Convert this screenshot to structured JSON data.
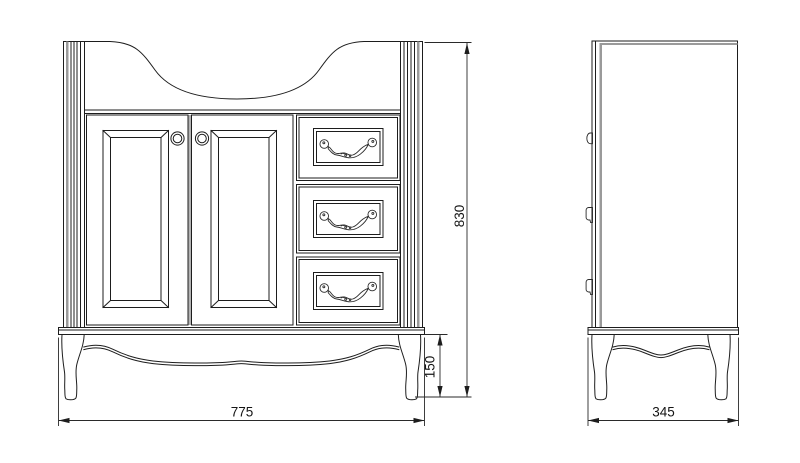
{
  "canvas": {
    "background": "#ffffff",
    "line_color": "#1d1d1d",
    "accent_gray": "#9a9a9a"
  },
  "drawing": {
    "subject": "bathroom vanity cabinet orthographic technical drawing",
    "views": {
      "front": {
        "name": "front elevation"
      },
      "side": {
        "name": "side elevation"
      }
    },
    "icons": {
      "door_knob": "round-knob",
      "drawer_pull": "ornate-swag-pull",
      "pilaster": "fluted-column"
    },
    "dimensions": {
      "width": {
        "label": "775"
      },
      "height": {
        "label": "830"
      },
      "leg_height": {
        "label": "150"
      },
      "depth": {
        "label": "345"
      }
    }
  }
}
